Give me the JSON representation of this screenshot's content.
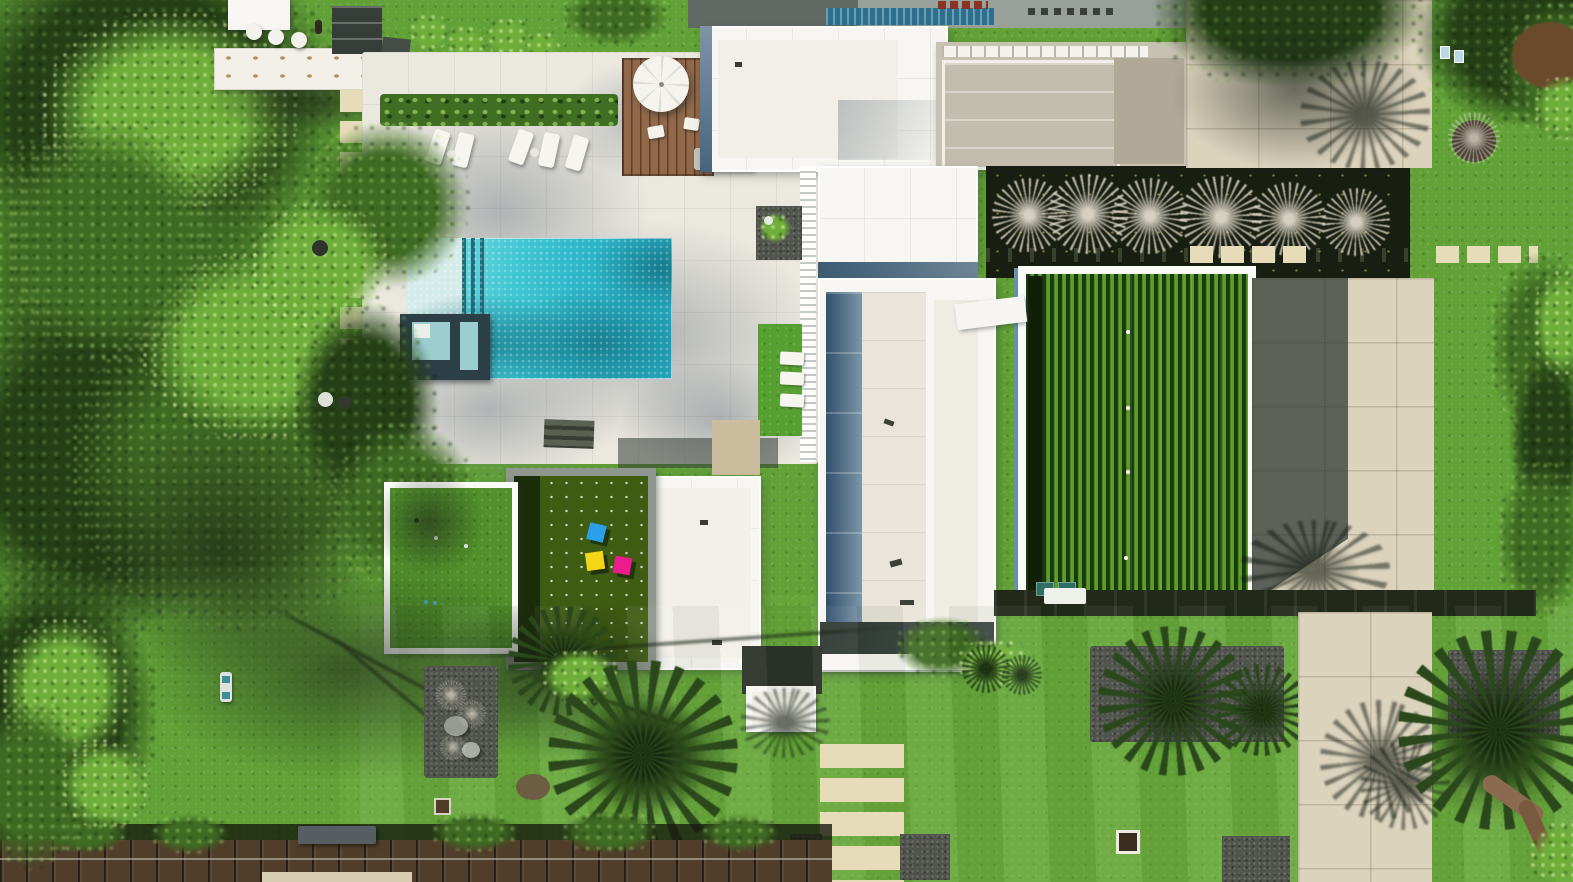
{
  "image": {
    "type": "aerial-drone-photograph",
    "subject": "Top-down aerial view of a modern white flat-roof luxury estate",
    "description": "Drone photo straight down over a contemporary mansion: turquoise pool with baja shelf and dark-framed spa, cream stone pool deck with sun loungers and a white umbrella on a wood deck, sculptural white roofs with slate-blue glass edges, a gray skylight roof, a sunken dark courtyard planted with bare trees, a white-framed artificial-turf lawn, a rooftop terrace with blue, yellow and magenta cube seats, a putting green, concrete driveway with tree shadows, palm trees, gravel planting beds, a rear boardwalk with bench, and dense surrounding tree canopy",
    "width_px": 1573,
    "height_px": 882
  },
  "colors": {
    "lawn": "#61a136",
    "lawn-bright": "#79b947",
    "lawn-shade": "#2c4c16",
    "forest-dark": "#243f16",
    "forest-mid": "#3e6a22",
    "forest-bright": "#6fae3a",
    "foliage-light": "#8fc95d",
    "deck": "#ebe8df",
    "pool-light": "#d4ecea",
    "pool-aqua": "#3fc6d3",
    "pool-deep": "#157f97",
    "spa-frame": "#2c3e46",
    "spa-water": "#9ccdd0",
    "roof-white": "#f7f6f2",
    "roof-panel": "#efece3",
    "slate": "#48647c",
    "slate-light": "#7e95a8",
    "roof-gray": "#c7c1b2",
    "roof-gray-dark": "#b0a998",
    "courtyard": "#181e12",
    "bare-tree": "#ddd6c6",
    "turf-dark": "#1e3711",
    "turf-bright": "#58a02b",
    "drive": "#dcd3bd",
    "gravel": "#50544c",
    "rock": "#969a91",
    "wood-deck": "#91684a",
    "boardwalk": "#513e2a",
    "umbrella": "#f4f3ee",
    "cube-blue": "#2aa0e8",
    "cube-yellow": "#f5d517",
    "cube-magenta": "#ee1b8e",
    "wall-dark": "#222919",
    "slab": "#e6dcba",
    "hedge": "#477c26",
    "palm-dark": "#2a481b",
    "palm-core": "#16280d",
    "mulch": "#6b4a2c",
    "rust": "#8a6a50",
    "solar": "#2d6f8f",
    "vent-red": "#8a3324",
    "gate-white": "#eef0ea",
    "teal-unit": "#2f6e64"
  },
  "scene_objects": [
    {
      "name": "swimming-pool",
      "label": "Turquoise pool with baja shelf and three dark lap lines"
    },
    {
      "name": "spa",
      "label": "Square spa with dark stone surround"
    },
    {
      "name": "pool-deck",
      "label": "Cream stone pool deck with tree shadows"
    },
    {
      "name": "sun-loungers",
      "label": "White chaise loungers beside the pool"
    },
    {
      "name": "umbrella-deck",
      "label": "Wood deck with white umbrella and chairs"
    },
    {
      "name": "outdoor-kitchen",
      "label": "Outdoor kitchen bar with white stools"
    },
    {
      "name": "main-house",
      "label": "White flat-roof modern house with slate-blue glass edges"
    },
    {
      "name": "skylight-roof",
      "label": "Gray roof wing with white skylight band"
    },
    {
      "name": "sunken-courtyard",
      "label": "Dark sunken courtyard with bare trees"
    },
    {
      "name": "framed-turf-lawn",
      "label": "White-framed artificial turf lawn, half in shadow"
    },
    {
      "name": "rooftop-terrace",
      "label": "Green roof terrace with blue, yellow and magenta cubes"
    },
    {
      "name": "putting-green",
      "label": "White-framed putting green"
    },
    {
      "name": "driveway",
      "label": "Concrete paver driveway with building and tree shadows"
    },
    {
      "name": "palm-trees",
      "label": "Palm trees over the back lawn"
    },
    {
      "name": "gravel-beds",
      "label": "Gray gravel planting beds with rocks and grasses"
    },
    {
      "name": "paver-path",
      "label": "Cream stepping-slab paths"
    },
    {
      "name": "boardwalk",
      "label": "Rear wood boardwalk with bench"
    },
    {
      "name": "garden-wall",
      "label": "Dark garden wall with white gate and equipment"
    },
    {
      "name": "tree-canopy",
      "label": "Mature tree canopy on the left and corners"
    },
    {
      "name": "lawn",
      "label": "Sunlit green lawns"
    }
  ]
}
